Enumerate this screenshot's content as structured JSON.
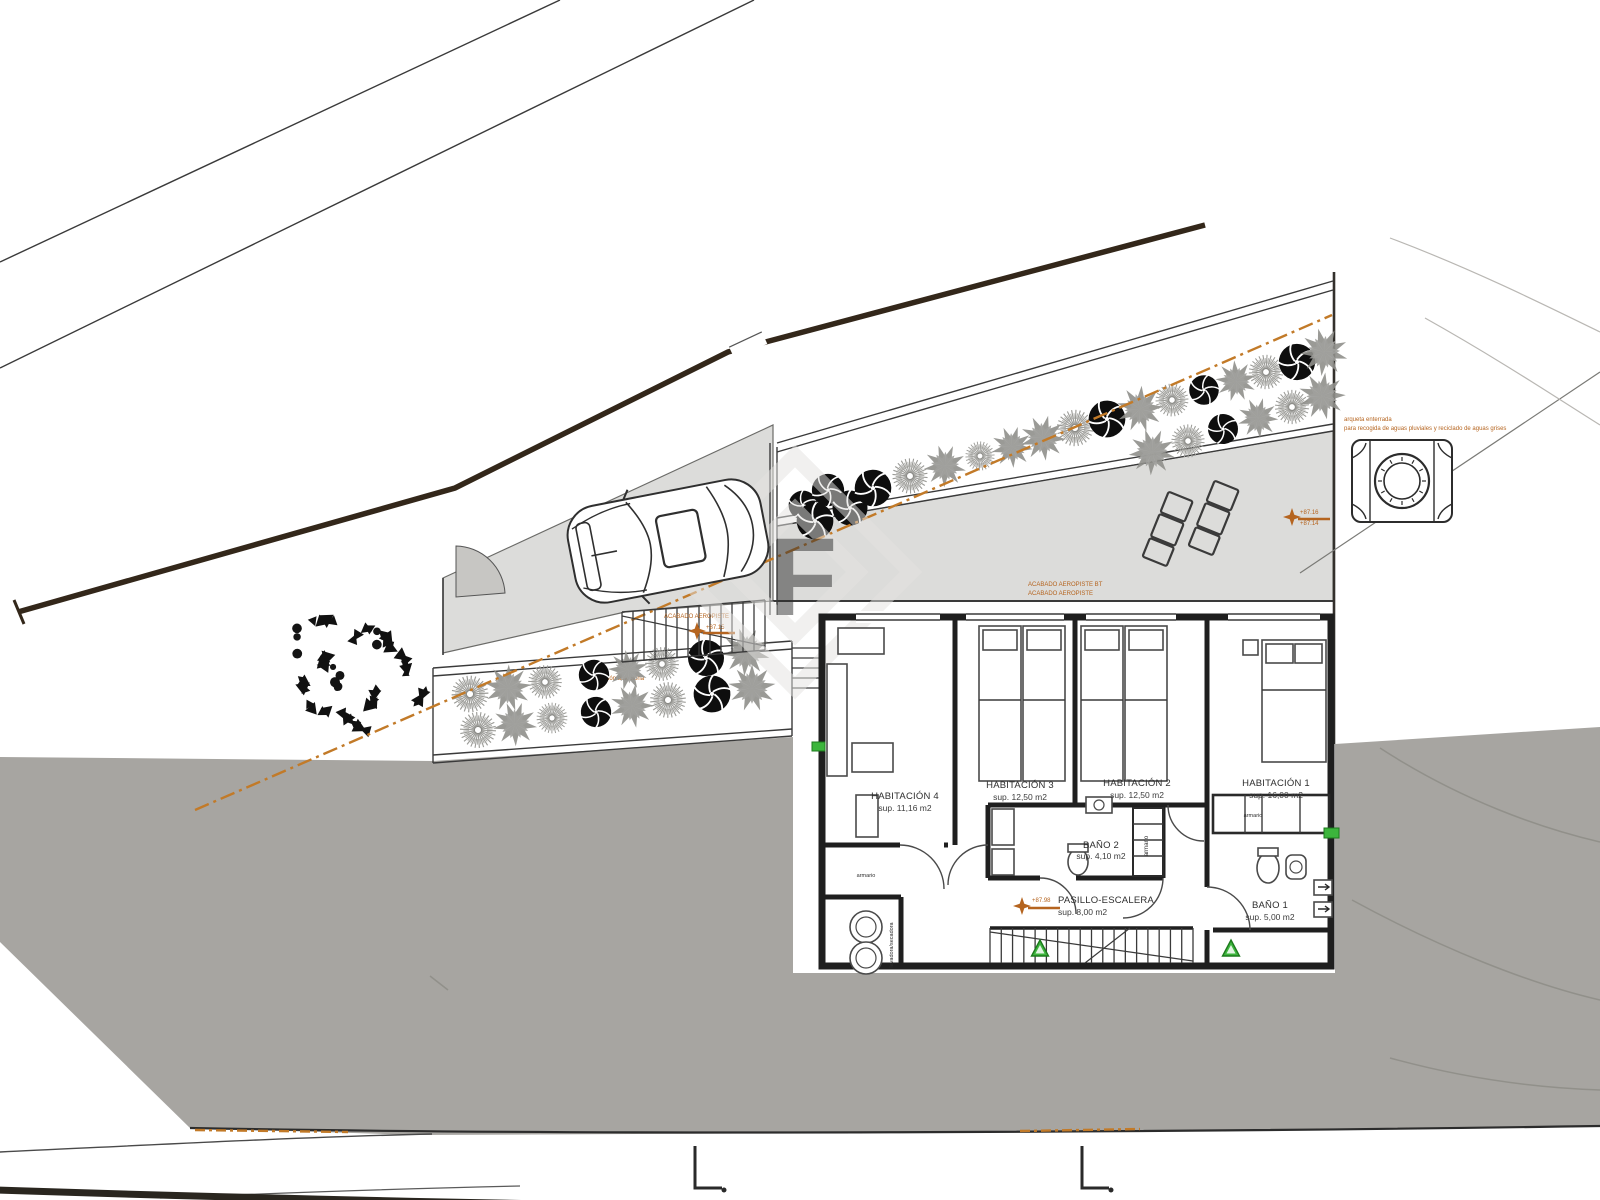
{
  "rooms": [
    {
      "name": "HABITACIÓN 4",
      "area": "sup. 11,16 m2"
    },
    {
      "name": "HABITACIÓN 3",
      "area": "sup. 12,50 m2"
    },
    {
      "name": "HABITACIÓN 2",
      "area": "sup. 12,50 m2"
    },
    {
      "name": "HABITACIÓN 1",
      "area": "sup. 16,00 m2"
    },
    {
      "name": "BAÑO 2",
      "area": "sup. 4,10 m2"
    },
    {
      "name": "BAÑO 1",
      "area": "sup. 5,00 m2"
    },
    {
      "name": "PASILLO-ESCALERA",
      "area": "sup. 8,00 m2"
    }
  ],
  "labels": {
    "closet_hall": "armario",
    "closet_bath": "armario",
    "laundry": "lavadora/secadora",
    "finish_terrace_1": "ACABADO AEROPISTE BT",
    "finish_terrace_2": "ACABADO AEROPISTE",
    "finish_stairs": "ACABADO AEROPISTE",
    "garden_note": "vegetación autóctona",
    "cistern_note_1": "arqueta enterrada",
    "cistern_note_2": "para recogida de aguas pluviales y reciclado de aguas grises",
    "elev_terrace_1": "+87.16",
    "elev_terrace_2": "+87.14",
    "elev_stairs": "+87.15",
    "elev_hall": "+87.98",
    "watermark": "F"
  },
  "colors": {
    "accent_orange": "#b5641f",
    "boundary_orange": "#c27a28",
    "marker_green": "#3cb53c",
    "terrain_gray": "#a7a5a1",
    "paving_gray": "#dcdcda",
    "plant_gray": "#92928e",
    "wall_dark": "#1f1f1f"
  }
}
